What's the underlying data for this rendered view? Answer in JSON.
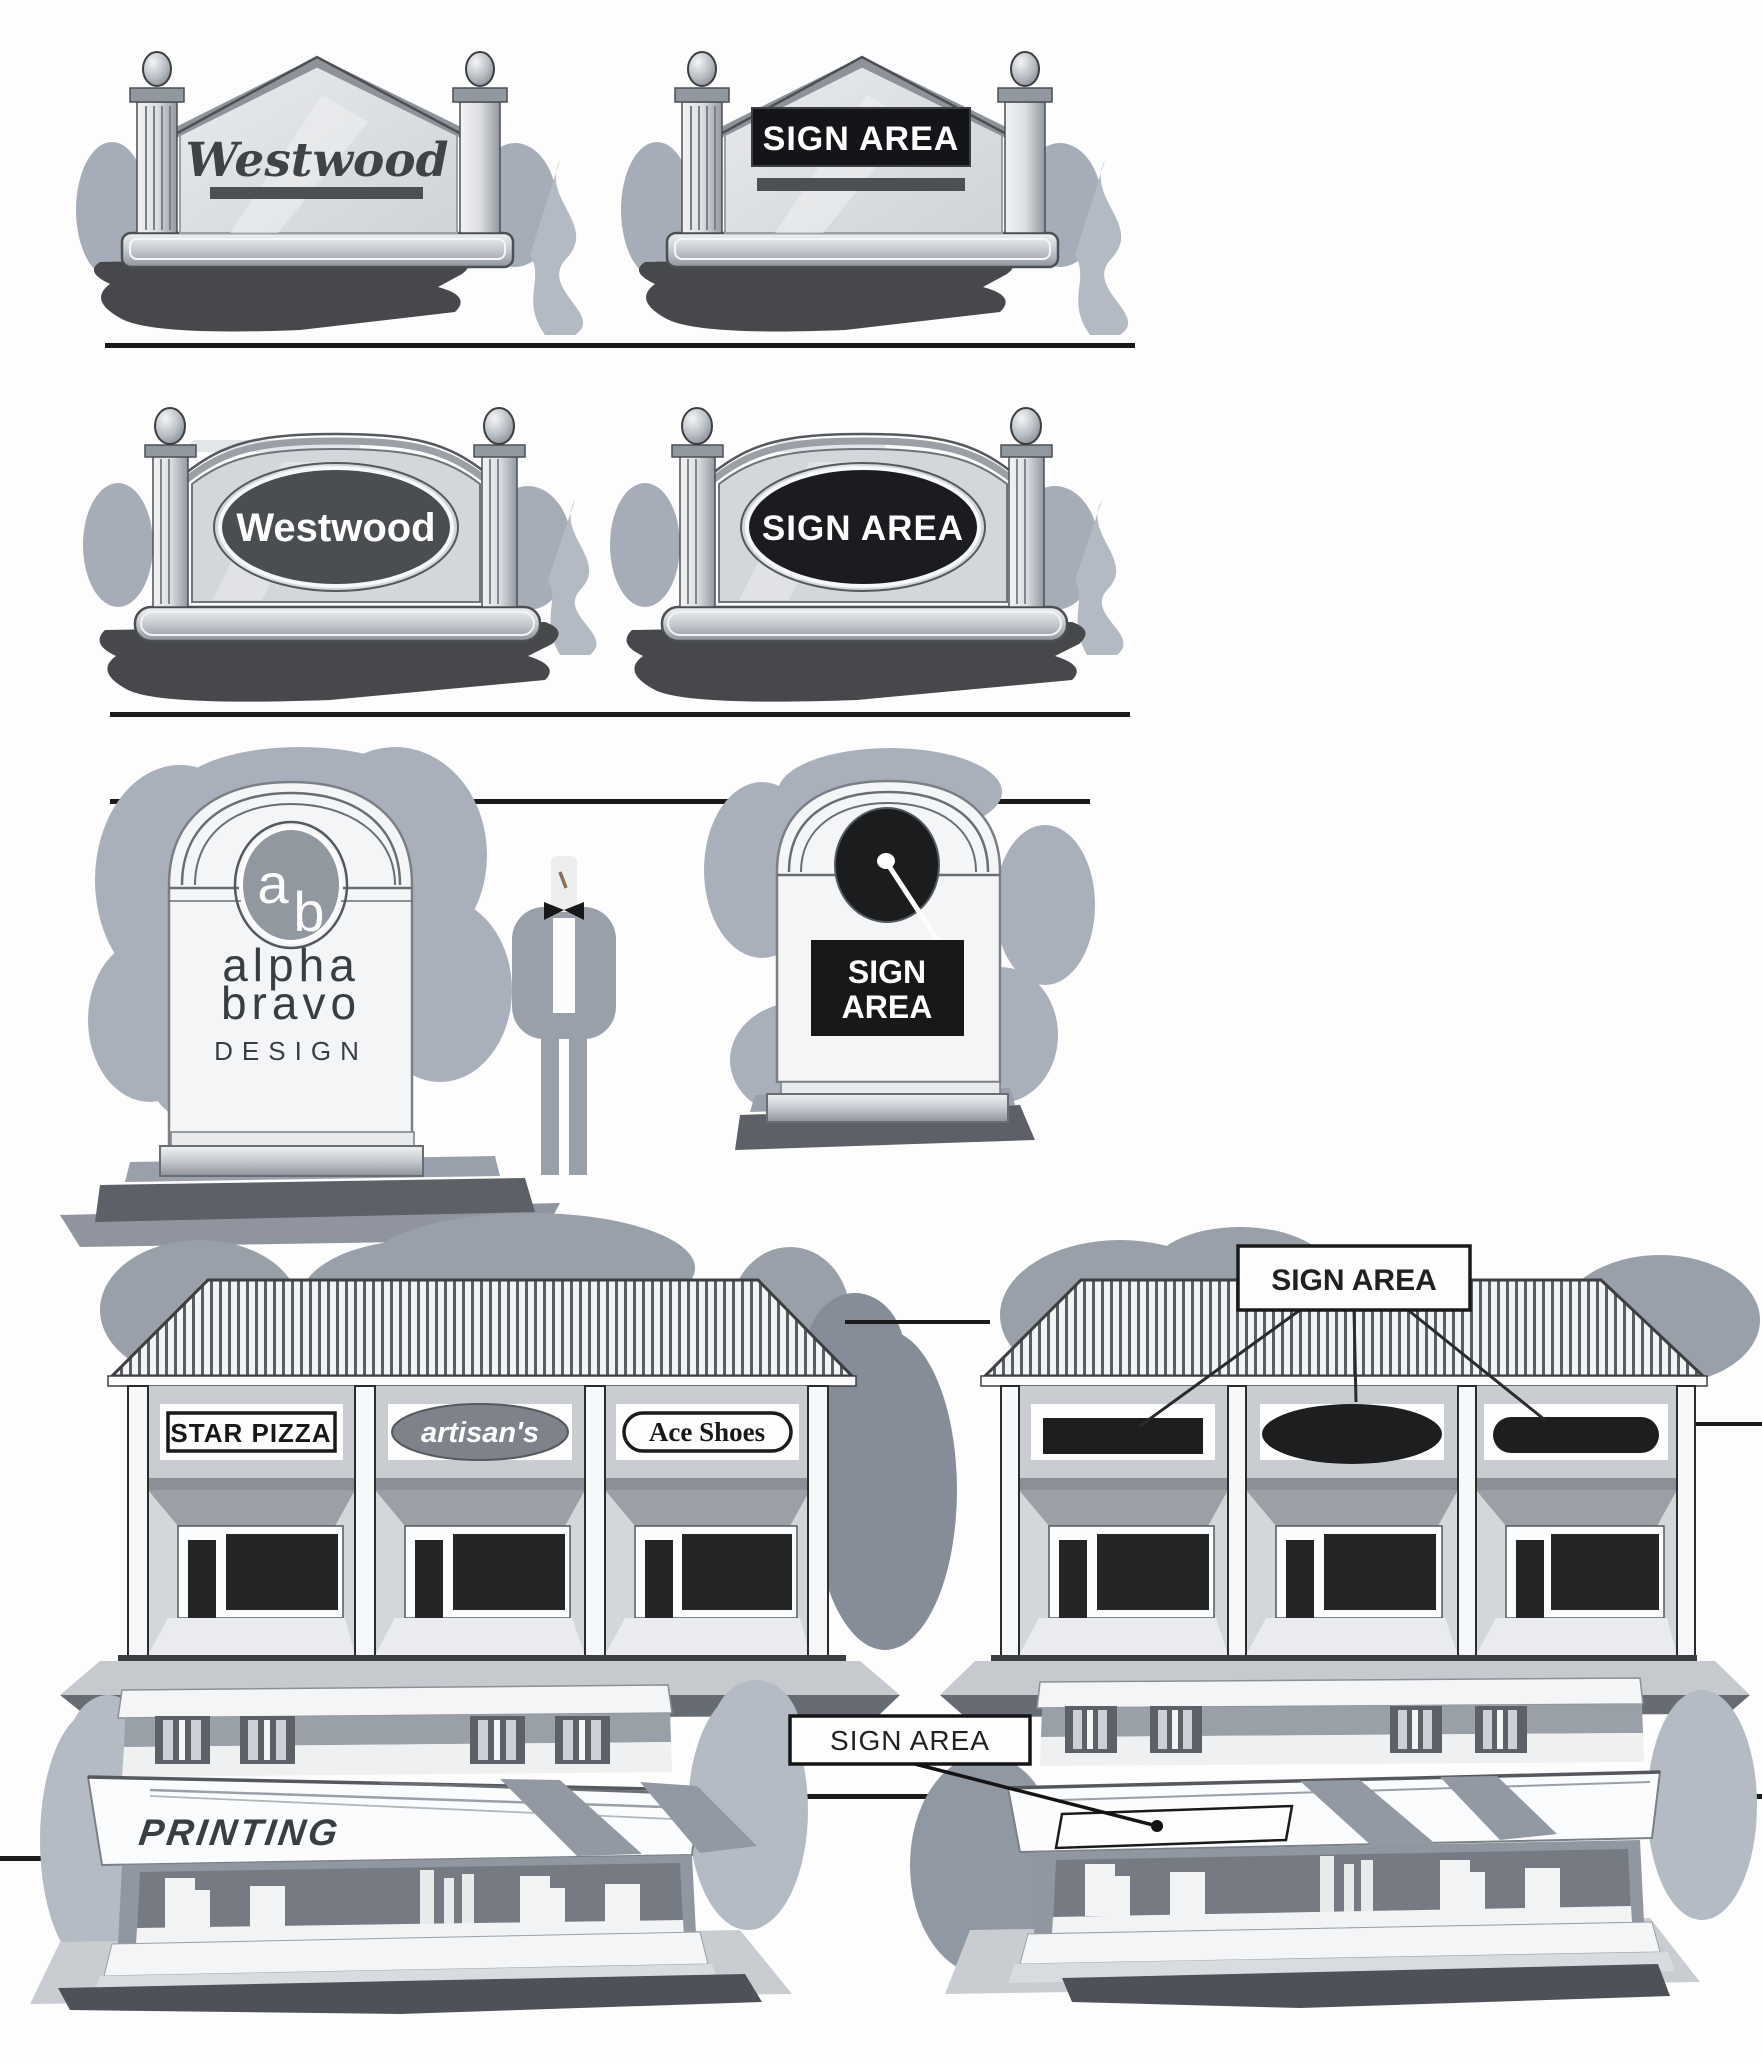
{
  "colors": {
    "background": "#fdfdfd",
    "ink_line": "#1a1a1a",
    "sign_panel_black": "#17181b",
    "monument_face": "#dcdee1",
    "bush_gray": "#a7adb8",
    "ground_shadow_dark": "#46484c",
    "tree_gray": "#99a0aa",
    "fascia_gray": "#c9ccd1"
  },
  "row1": {
    "left_sign": {
      "text": "Westwood"
    },
    "right_sign": {
      "text": "SIGN AREA"
    }
  },
  "row2": {
    "left_sign": {
      "text": "Westwood"
    },
    "right_sign": {
      "text": "SIGN AREA"
    }
  },
  "row3": {
    "left_sign": {
      "logo_a": "a",
      "logo_b": "b",
      "line1": "alpha",
      "line2": "bravo",
      "line3": "DESIGN"
    },
    "right_sign": {
      "line1": "SIGN",
      "line2": "AREA"
    }
  },
  "row4": {
    "left_building": {
      "tenant1": "STAR PIZZA",
      "tenant2": "artisan's",
      "tenant3": "Ace Shoes"
    },
    "right_building": {
      "callout": "SIGN AREA"
    }
  },
  "row5": {
    "left_building": {
      "awning_text": "PRINTING"
    },
    "right_building": {
      "callout": "SIGN AREA"
    }
  }
}
